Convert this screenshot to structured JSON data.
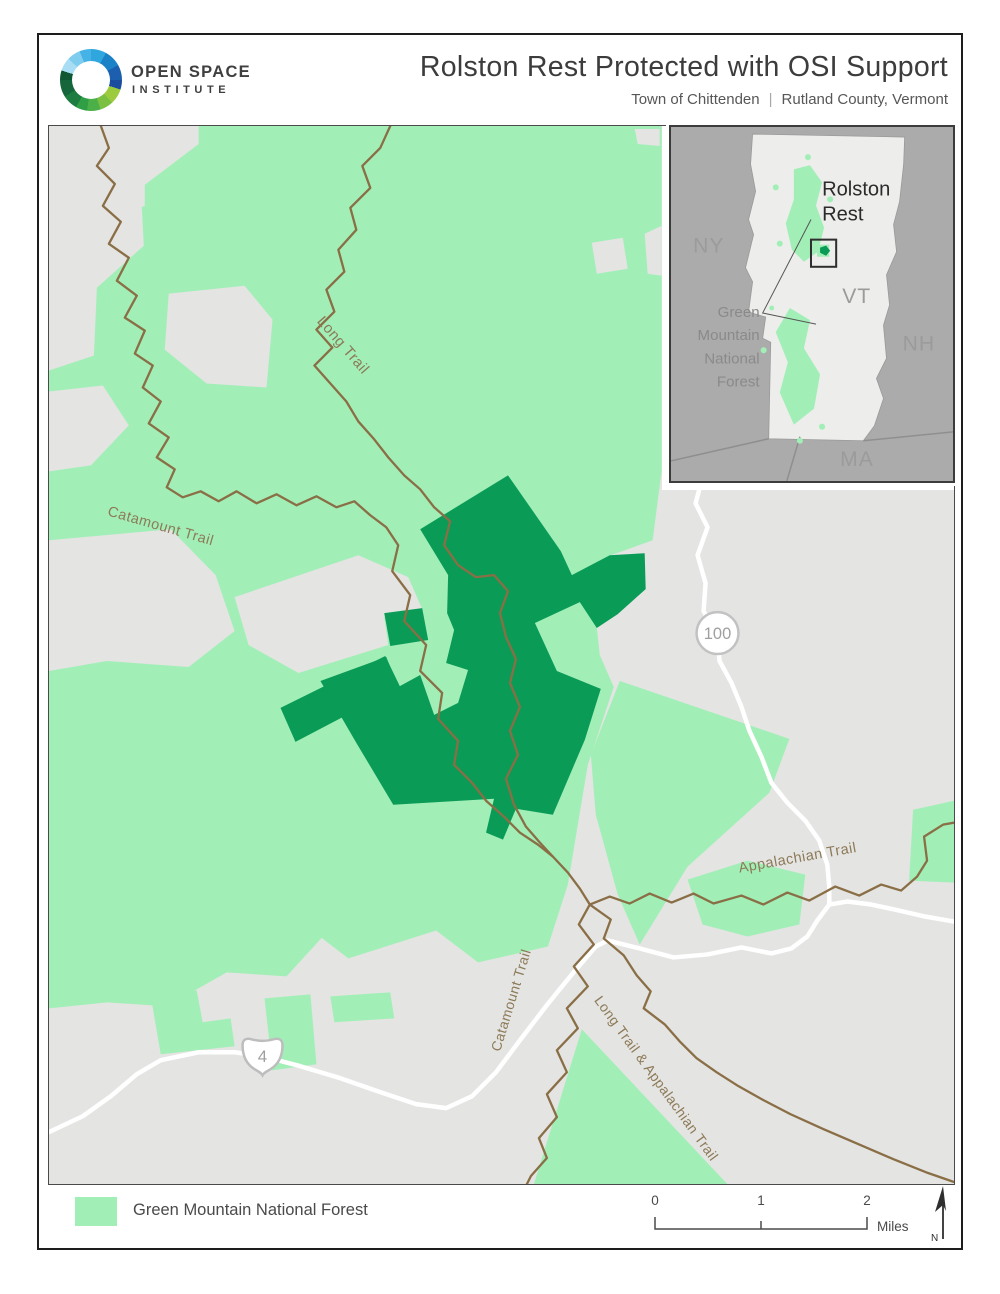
{
  "header": {
    "logo_line1": "OPEN SPACE",
    "logo_line2": "INSTITUTE",
    "title": "Rolston Rest Protected with OSI Support",
    "subtitle_left": "Town of Chittenden",
    "subtitle_sep": "|",
    "subtitle_right": "Rutland County, Vermont"
  },
  "map": {
    "trail_labels": {
      "long_trail": "Long Trail",
      "catamount_west": "Catamount Trail",
      "appalachian": "Appalachian Trail",
      "catamount_south": "Catamount Trail",
      "long_appalachian": "Long Trail & Appalachian Trail"
    },
    "route_shields": {
      "route100": "100",
      "route4": "4"
    }
  },
  "inset": {
    "states": {
      "ny": "NY",
      "vt": "VT",
      "nh": "NH",
      "ma": "MA"
    },
    "labels": {
      "rolston_line1": "Rolston",
      "rolston_line2": "Rest",
      "gmnf": [
        "Green",
        "Mountain",
        "National",
        "Forest"
      ]
    }
  },
  "legend": {
    "forest_label": "Green Mountain National Forest"
  },
  "scalebar": {
    "ticks": [
      "0",
      "1",
      "2"
    ],
    "unit": "Miles"
  },
  "north_label": "N",
  "colors": {
    "pagebg": "#ffffff",
    "ink": "#3c3c3c",
    "subtle": "#575757",
    "mapbg": "#e4e4e2",
    "forest": "#a1efb7",
    "protected": "#0a9b57",
    "trail": "#8a6e46",
    "traillabel": "#8d7a58",
    "road": "#ffffff",
    "roadlabel": "#9f9f9f",
    "stategray": "#ababab",
    "vtfill": "#ededeb",
    "insetlabel": "#9b9b9b",
    "framedark": "#1d1d1d",
    "mapframe": "#4a4a4a",
    "shieldstroke": "#c2c2c2"
  }
}
